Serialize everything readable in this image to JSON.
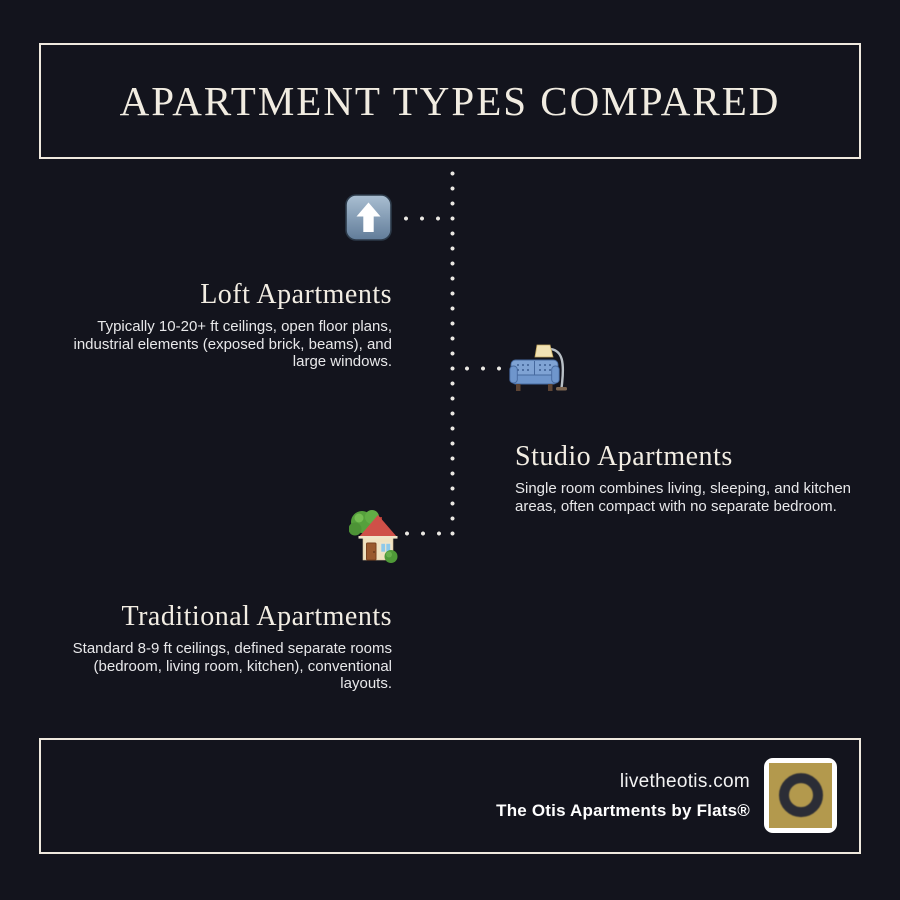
{
  "theme": {
    "background": "#13141d",
    "frame_border": "#efe9de",
    "heading_color": "#f1ece1",
    "body_text_color": "#e8e8ea",
    "dot_color": "#e9e7e2"
  },
  "header": {
    "title": "APARTMENT TYPES COMPARED"
  },
  "timeline": {
    "sections": [
      {
        "id": "loft",
        "side": "left",
        "icon": "up-arrow-icon",
        "title": "Loft Apartments",
        "description": "Typically 10-20+ ft ceilings, open floor plans, industrial elements (exposed brick, beams), and large windows."
      },
      {
        "id": "studio",
        "side": "right",
        "icon": "couch-lamp-icon",
        "title": "Studio Apartments",
        "description": "Single room combines living, sleeping, and kitchen areas, often compact with no separate bedroom."
      },
      {
        "id": "traditional",
        "side": "left",
        "icon": "house-garden-icon",
        "title": "Traditional Apartments",
        "description": "Standard 8-9 ft ceilings, defined separate rooms (bedroom, living room, kitchen), conventional layouts."
      }
    ]
  },
  "footer": {
    "website": "livetheotis.com",
    "brand": "The Otis Apartments by Flats®",
    "logo": {
      "letter": "O",
      "background": "#b3994d",
      "ring_color": "#2b2d36",
      "frame_color": "#ffffff"
    }
  }
}
